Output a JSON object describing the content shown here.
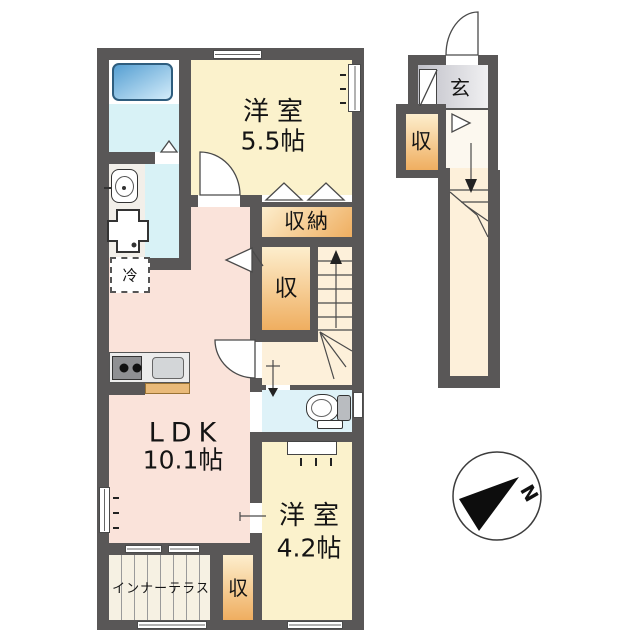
{
  "colors": {
    "wall": "#595757",
    "ldk": "#fae3da",
    "bedroom": "#fbf2cc",
    "storage_light": "#fdeecd",
    "storage_dark": "#efae60",
    "bath": "#d8f2f6",
    "toilet": "#def2f8",
    "hall": "#fdf0da",
    "sanitary": "#f2efe9",
    "entrance_light": "#f0f0f2",
    "entrance_dark": "#c0c0c8",
    "terrace": "#f6f1e3",
    "tub_light": "#d3ecfa",
    "tub_dark": "#569fd2",
    "counter_tan": "#e9ba79"
  },
  "rooms": {
    "ldk": {
      "name": "LDK",
      "size": "10.1帖"
    },
    "bedroom_upper": {
      "name": "洋室",
      "size": "5.5帖"
    },
    "bedroom_lower": {
      "name": "洋室",
      "size": "4.2帖"
    },
    "closet": "収納",
    "storage_mid": "収",
    "storage_bottom": "収",
    "storage_entry": "収",
    "entrance": "玄",
    "refrigerator": "冷",
    "inner_terrace": "インナーテラス"
  },
  "compass": {
    "north_label": "N"
  }
}
